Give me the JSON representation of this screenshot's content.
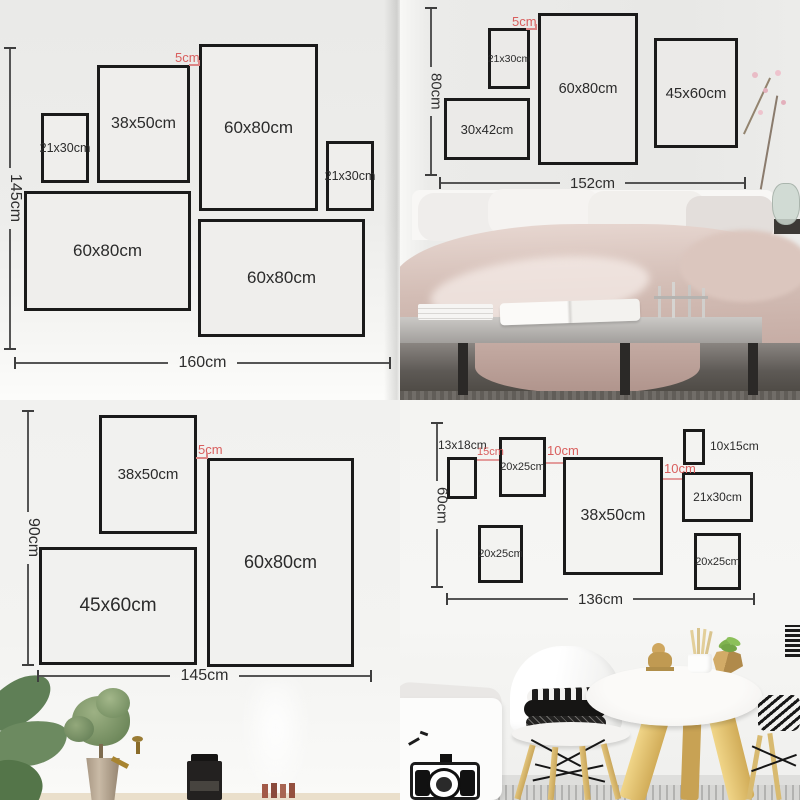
{
  "colors": {
    "annotation_red": "#d95f5e",
    "frame_border": "#1a1a1a",
    "dim_line": "#4a4a4a"
  },
  "tl": {
    "gap": "5cm",
    "height": "145cm",
    "width": "160cm",
    "frames": [
      "21x30cm",
      "38x50cm",
      "60x80cm",
      "21x30cm",
      "60x80cm",
      "60x80cm"
    ]
  },
  "tr": {
    "gap": "5cm",
    "height": "80cm",
    "width": "152cm",
    "frames": [
      "21x30cm",
      "60x80cm",
      "45x60cm",
      "30x42cm"
    ]
  },
  "bl": {
    "gap": "5cm",
    "height": "90cm",
    "width": "145cm",
    "frames": [
      "38x50cm",
      "60x80cm",
      "45x60cm"
    ]
  },
  "br": {
    "height": "60cm",
    "width": "136cm",
    "gaps": [
      "15cm",
      "10cm",
      "10cm"
    ],
    "frames": [
      "13x18cm",
      "20x25cm",
      "38x50cm",
      "10x15cm",
      "21x30cm",
      "20x25cm",
      "20x25cm"
    ]
  }
}
